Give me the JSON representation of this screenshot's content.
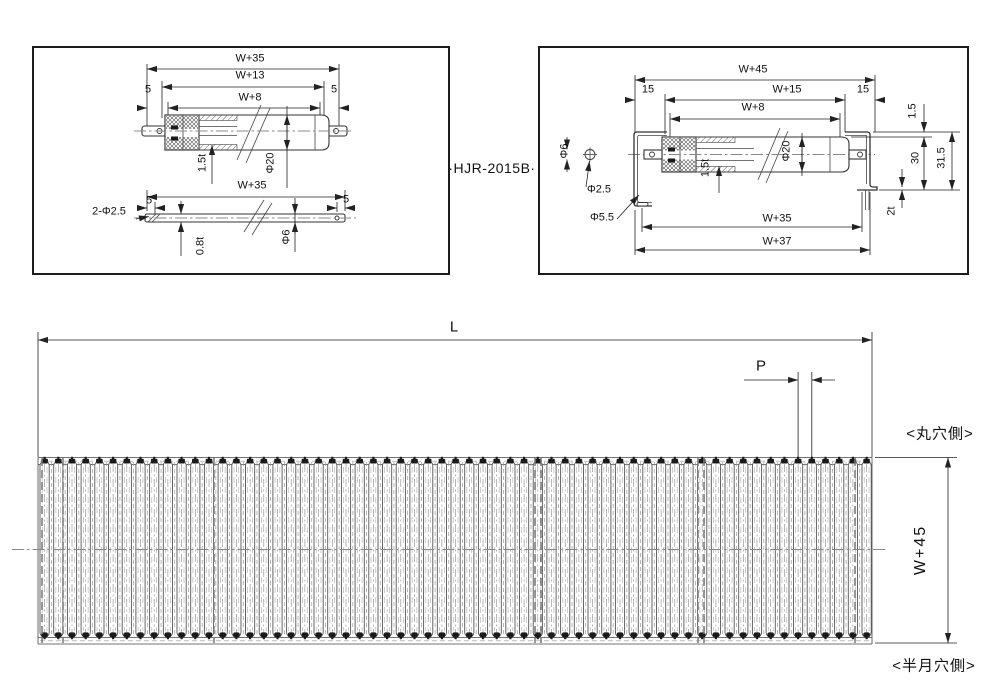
{
  "model_label": "·HJR-2015B·",
  "colors": {
    "line": "#222222",
    "outline": "#333333",
    "centerline": "#888888",
    "roller_gray": "#555555",
    "cap_black": "#1a1a1a",
    "background": "#ffffff"
  },
  "left_view": {
    "top": {
      "w35": "W+35",
      "w13": "W+13",
      "w8": "W+8",
      "five": "5",
      "wall_thickness": "1.5t",
      "roller_dia": "Φ20"
    },
    "bottom": {
      "w35": "W+35",
      "five": "5",
      "holes": "2-Φ2.5",
      "shaft_wall": "0.8t",
      "shaft_dia": "Φ6"
    }
  },
  "right_view": {
    "w45": "W+45",
    "fifteen": "15",
    "w15": "W+15",
    "w8": "W+8",
    "shaft_dia": "Φ6",
    "pin_hole_dia": "Φ2.5",
    "frame_hole_dia": "Φ5.5",
    "wall_thickness": "1.5t",
    "roller_dia": "Φ20",
    "one_five": "1.5",
    "thirty": "30",
    "thirty_one_five": "31.5",
    "frame_thickness": "2t",
    "w35": "W+35",
    "w37": "W+37"
  },
  "plan_view": {
    "length_label": "L",
    "pitch_label": "P",
    "width_label": "W+45",
    "round_hole_side": "<丸穴側>",
    "half_moon_hole_side": "<半月穴側>",
    "roller_count": 61
  }
}
